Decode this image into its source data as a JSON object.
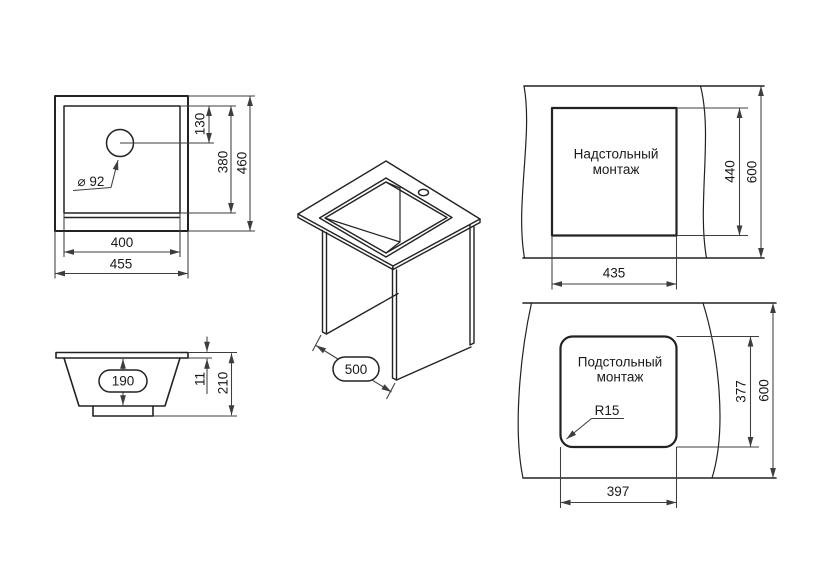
{
  "drawing": {
    "top_view": {
      "hole_diameter": "⌀ 92",
      "hole_offset": "130",
      "bowl_width": "400",
      "bowl_depth": "380",
      "overall_width": "455",
      "overall_depth": "460"
    },
    "front_view": {
      "bowl_inner_depth": "190",
      "rim_height": "11",
      "overall_height": "210"
    },
    "iso_view": {
      "cabinet_width": "500"
    },
    "surface_mount_view": {
      "title_line1": "Надстольный",
      "title_line2": "монтаж",
      "cutout_width": "435",
      "cutout_depth": "440",
      "counter_depth": "600"
    },
    "under_mount_view": {
      "title_line1": "Подстольный",
      "title_line2": "монтаж",
      "cutout_width": "397",
      "cutout_depth": "377",
      "counter_depth": "600",
      "corner_radius": "R15"
    }
  },
  "colors": {
    "background": "#ffffff",
    "object_line": "#222222",
    "dim_line": "#3d3d3d",
    "text": "#1a1a1a"
  }
}
